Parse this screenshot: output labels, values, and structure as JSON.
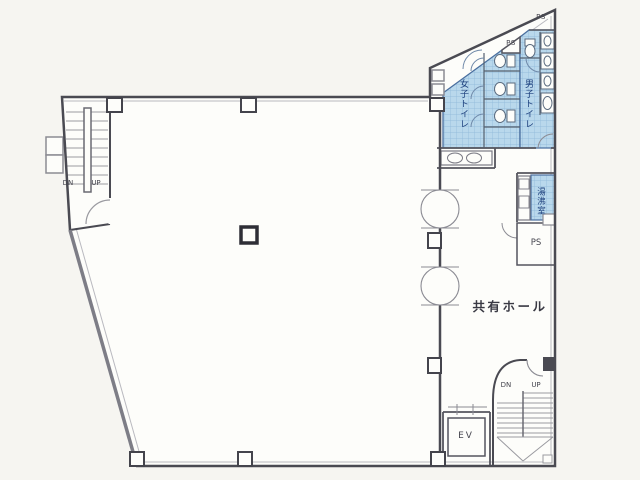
{
  "page": {
    "background": "#f6f5f1",
    "paper": "#fdfdfa"
  },
  "colors": {
    "wall": "#4a4a52",
    "wall_light": "#8b8b93",
    "wet_area_fill": "#b9d8ec",
    "wet_area_grid": "#8cb6d8",
    "wet_area_border": "#4a6f9f",
    "label_blue": "#1c3f7c",
    "label_dark": "#3a3a44"
  },
  "floor_plan": {
    "stairwell_nw": {
      "down_label": "DN",
      "up_label": "UP"
    },
    "stairwell_se": {
      "down_label": "DN",
      "up_label": "UP"
    },
    "toilets": {
      "pipe_shaft_top": "PS",
      "pipe_shaft_mid": "PS",
      "womens_label": "女子トイレ",
      "mens_label": "男子トイレ"
    },
    "kitchenette_label": "湯沸室",
    "pipe_shaft_low": "PS",
    "hall_label": "共有ホール",
    "elevator_label": "EV"
  }
}
